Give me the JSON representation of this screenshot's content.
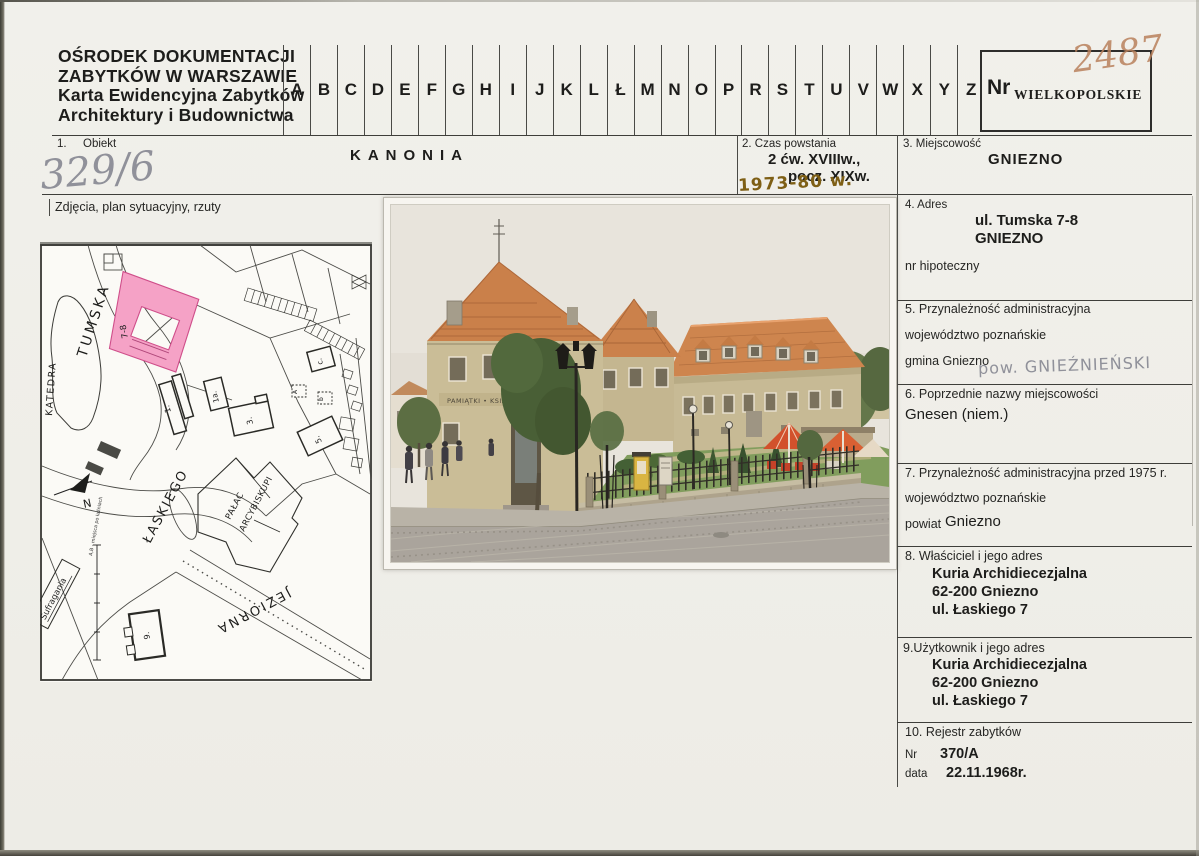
{
  "document": {
    "institution": [
      "OŚRODEK DOKUMENTACJI",
      "ZABYTKÓW W WARSZAWIE",
      "Karta Ewidencyjna Zabytków",
      "Architektury i Budownictwa"
    ],
    "index_letters": [
      "A",
      "B",
      "C",
      "D",
      "E",
      "F",
      "G",
      "H",
      "I",
      "J",
      "K",
      "L",
      "Ł",
      "M",
      "N",
      "O",
      "P",
      "R",
      "S",
      "T",
      "U",
      "V",
      "W",
      "X",
      "Y",
      "Z"
    ],
    "nr_label": "Nr",
    "voivodeship_stamp": "WIELKOPOLSKIE",
    "handwritten_card_number": "2487",
    "handwritten_inventory_number": "329/6"
  },
  "fields": {
    "f1": {
      "no": "1.",
      "label": "Obiekt",
      "value": "KANONIA"
    },
    "f2": {
      "label": "2. Czas powstania",
      "line1": "2 ćw. XVIIIw.,",
      "line2": "pocz. XIXw.",
      "handwritten": "1973-80 w."
    },
    "f3": {
      "label": "3. Miejscowość",
      "value": "GNIEZNO"
    },
    "f4": {
      "label": "4. Adres",
      "line1": "ul. Tumska 7-8",
      "line2": "GNIEZNO",
      "note": "nr hipoteczny"
    },
    "f5": {
      "label": "5. Przynależność administracyjna",
      "line1": "województwo poznańskie",
      "line2": "gmina Gniezno",
      "handwritten": "pow. GNIEŹNIEŃSKI"
    },
    "f6": {
      "label": "6. Poprzednie nazwy miejscowości",
      "value": "Gnesen (niem.)"
    },
    "f7": {
      "label": "7. Przynależność administracyjna przed 1975 r.",
      "line1": "województwo poznańskie",
      "line2_label": "powiat",
      "line2_value": "Gniezno"
    },
    "f8": {
      "label": "8. Właściciel i jego adres",
      "line1": "Kuria Archidiecezjalna",
      "line2": "62-200 Gniezno",
      "line3": "ul. Łaskiego 7"
    },
    "f9": {
      "label": "9.Użytkownik i jego adres",
      "line1": "Kuria Archidiecezjalna",
      "line2": "62-200 Gniezno",
      "line3": "ul. Łaskiego 7"
    },
    "f10": {
      "label": "10. Rejestr zabytków",
      "nr_label": "Nr",
      "nr_value": "370/A",
      "date_label": "data",
      "date_value": "22.11.1968r."
    }
  },
  "attachments_caption": "Zdjęcia, plan sytuacyjny, rzuty",
  "map": {
    "streets": {
      "tumska": "TUMSKA",
      "laskiego": "ŁASKIEGO",
      "jeziorna": "JEZIORNA"
    },
    "places": {
      "katedra": "KATEDRA",
      "palac1": "PAŁAC",
      "palac2": "ARCYBISKUPI",
      "sufragania": "Sufragania"
    },
    "highlight_label": "7-8",
    "buildings": {
      "b1": "1.",
      "b1a": "1a.",
      "b3": "3.",
      "b5": "5.",
      "b9": "9.",
      "bc": "c.",
      "bA": "A",
      "bb": "b"
    },
    "note": "A,B - miejsca po łaźniach",
    "north_label": "N",
    "highlight_color": "#f5a2c6"
  },
  "photo": {
    "sign_text": "PAMIĄTKI • KSIĄŻKI"
  },
  "colors": {
    "highlight_pink": "#f5a2c6",
    "ink_sepia": "#b9815c",
    "ink_brown": "#7e5f15",
    "pencil": "#90919a"
  }
}
